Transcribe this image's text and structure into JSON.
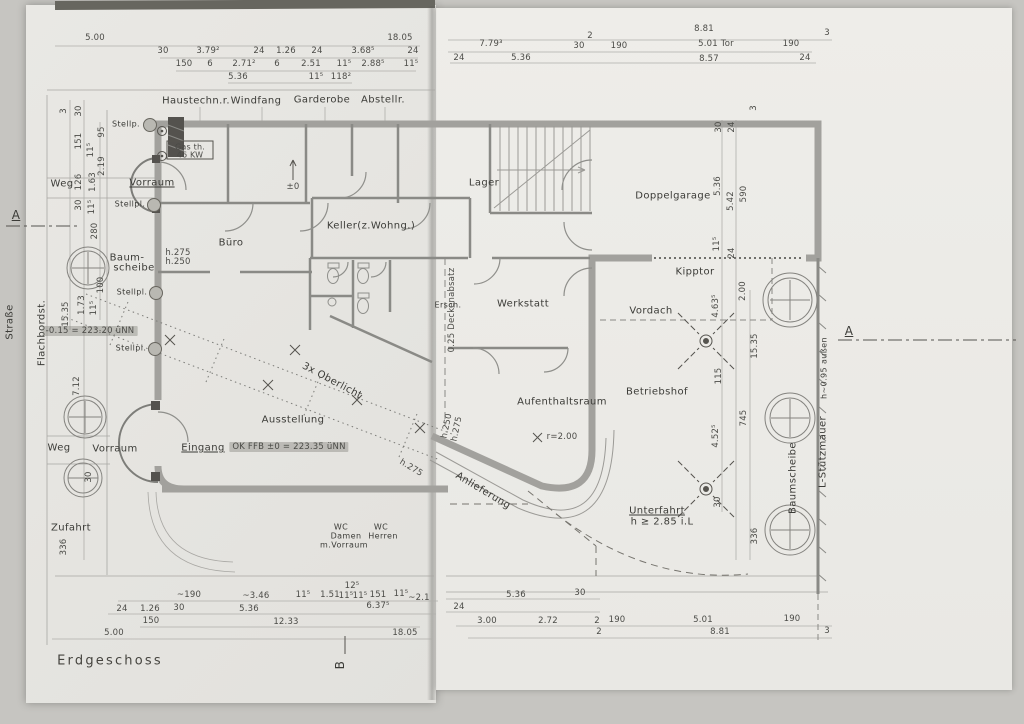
{
  "title": "Erdgeschoss",
  "colors": {
    "paper_left": "#e6e5e1",
    "paper_right": "#edece8",
    "wall_gray": "#a2a19d",
    "line_dark": "#55534f",
    "text": "#3b3b37",
    "highlight": "#7a786f"
  },
  "labels": {
    "haustech": "Haustechn.r.",
    "windfang": "Windfang",
    "garderobe": "Garderobe",
    "abstell": "Abstellr.",
    "vorraum_top": "Vorraum",
    "buero": "Büro",
    "keller": "Keller(z.Wohng.)",
    "lager": "Lager",
    "doppelgarage": "Doppelgarage",
    "kipptor": "Kipptor",
    "werkstatt": "Werkstatt",
    "vordach": "Vordach",
    "ersch": "Ersch.",
    "aufenthaltsraum": "Aufenthaltsraum",
    "betriebshof": "Betriebshof",
    "ausstellung": "Ausstellung",
    "oberlicht": "3x Oberlicht",
    "anlieferung": "Anlieferung",
    "eingang": "Eingang",
    "vorraum_entry": "Vorraum",
    "weg_top": "Weg",
    "weg_bottom": "Weg",
    "zufahrt": "Zufahrt",
    "strasse": "Straße",
    "flachbord": "Flachbordst.",
    "baum1": "Baum-",
    "baum2": "scheibe",
    "baumscheibe_r": "Baumscheibe",
    "stuetzmauer": "L-Stützmauer",
    "aussen": "h~0.95 außen",
    "unterfahrt1": "Unterfahrt",
    "unterfahrt2": "h ≥ 2.85 i.L",
    "wc1": "WC",
    "wc2": "Damen",
    "wc3": "m.Vorraum",
    "wc4": "WC",
    "wc5": "Herren",
    "stellp1": "Stellp.",
    "stellp2": "Stellpl.",
    "stellp3": "Stellpl.",
    "stellp4": "Stellpl."
  },
  "annos": {
    "h275": "h.275",
    "h250": "h.250",
    "h250b": "h.250",
    "h275b": "h.275",
    "h275d": "h.275",
    "gas1": "Gas th.",
    "gas2": "46 KW",
    "pm0": "±0",
    "deckenabsatz": "0.25 Deckenabsatz",
    "radius": "r=2.00",
    "level_ffb": "OK FFB ±0 = 223.35 üNN",
    "level_street": "-0.15 = 223.20 üNN"
  },
  "section": {
    "a_left": "A",
    "a_right": "A",
    "b": "B"
  },
  "dims": {
    "tl": [
      "5.00",
      "18.05",
      "30",
      "3.79²",
      "24",
      "1.26",
      "24",
      "3.68⁵",
      "24",
      "150",
      "6",
      "2.71²",
      "6",
      "2.51",
      "11⁵",
      "2.88⁵",
      "11⁵",
      "5.36",
      "11⁵",
      "118²"
    ],
    "tr": [
      "8.81",
      "7.79³",
      "2",
      "30",
      "190",
      "5.01 Tor",
      "190",
      "3",
      "24",
      "5.36",
      "8.57",
      "24"
    ],
    "lv": [
      "3",
      "30",
      "151",
      "95",
      "11⁵",
      "2.19",
      "126",
      "1.63",
      "30",
      "11⁵",
      "280",
      "100",
      "1.73",
      "11⁵",
      "15.35",
      "7.12",
      "30",
      "336"
    ],
    "rv": [
      "3",
      "30",
      "24",
      "5.36",
      "5.42",
      "590",
      "11⁵",
      "24",
      "2.00",
      "4.63⁵",
      "15.35",
      "115",
      "745",
      "4.52⁵",
      "30",
      "336"
    ],
    "bl": [
      "~190",
      "~3.46",
      "11⁵",
      "1.51",
      "12⁵",
      "11⁵",
      "11⁵",
      "151",
      "11⁵",
      "~2.1",
      "24",
      "1.26",
      "30",
      "5.36",
      "6.37⁵",
      "150",
      "12.33",
      "5.00",
      "18.05"
    ],
    "br": [
      "5.36",
      "30",
      "24",
      "3.00",
      "2.72",
      "2",
      "190",
      "5.01",
      "190",
      "2",
      "8.81",
      "3"
    ]
  }
}
